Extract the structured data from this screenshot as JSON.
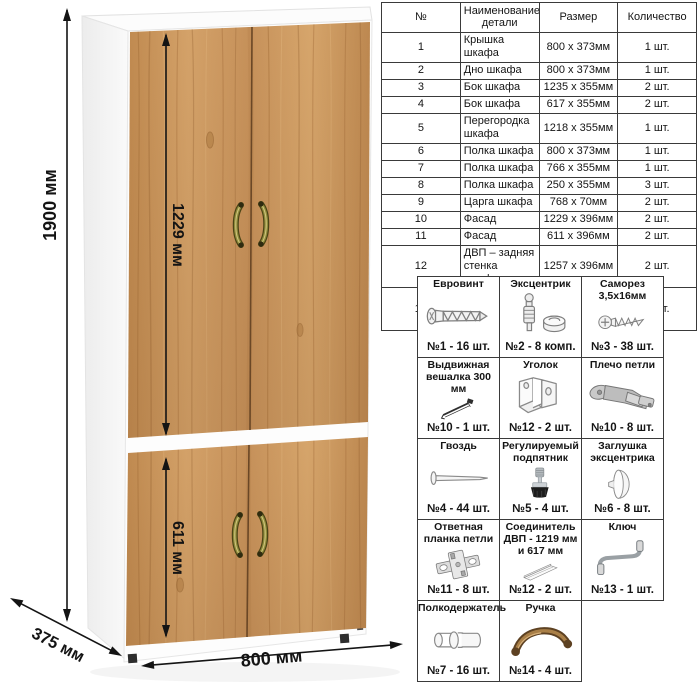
{
  "dimensions": {
    "height": "1900 мм",
    "upper_door_height": "1229 мм",
    "lower_door_height": "611 мм",
    "width": "800 мм",
    "depth": "375 мм"
  },
  "parts_table": {
    "headers": [
      "№",
      "Наименование детали",
      "Размер",
      "Количество"
    ],
    "rows": [
      [
        "1",
        "Крышка шкафа",
        "800 x 373мм",
        "1 шт."
      ],
      [
        "2",
        "Дно шкафа",
        "800 x 373мм",
        "1 шт."
      ],
      [
        "3",
        "Бок шкафа",
        "1235 x 355мм",
        "2 шт."
      ],
      [
        "4",
        "Бок шкафа",
        "617 x 355мм",
        "2 шт."
      ],
      [
        "5",
        "Перегородка шкафа",
        "1218 x 355мм",
        "1 шт."
      ],
      [
        "6",
        "Полка шкафа",
        "800 x 373мм",
        "1 шт."
      ],
      [
        "7",
        "Полка шкафа",
        "766 x 355мм",
        "1 шт."
      ],
      [
        "8",
        "Полка шкафа",
        "250 x 355мм",
        "3 шт."
      ],
      [
        "9",
        "Царга шкафа",
        "768 x 70мм",
        "2 шт."
      ],
      [
        "10",
        "Фасад",
        "1229 x 396мм",
        "2 шт."
      ],
      [
        "11",
        "Фасад",
        "611 x 396мм",
        "2 шт."
      ],
      [
        "12",
        "ДВП – задняя стенка шкафа",
        "1257 x 396мм",
        "2 шт."
      ],
      [
        "13",
        "ДВП – задняя стенка шкафа",
        "639 x 396мм",
        "2 шт."
      ]
    ]
  },
  "hardware": {
    "items": [
      {
        "title": "Евровинт",
        "qty": "№1 - 16 шт.",
        "icon": "euro-screw-icon"
      },
      {
        "title": "Эксцентрик",
        "qty": "№2 - 8 комп.",
        "icon": "cam-lock-icon"
      },
      {
        "title": "Саморез 3,5х16мм",
        "qty": "№3 - 38 шт.",
        "icon": "self-tapping-screw-icon"
      },
      {
        "title": "Выдвижная вешалка 300 мм",
        "qty": "№10 - 1 шт.",
        "icon": "pull-out-hanger-icon"
      },
      {
        "title": "Уголок",
        "qty": "№12 - 2 шт.",
        "icon": "corner-bracket-icon"
      },
      {
        "title": "Плечо петли",
        "qty": "№10 - 8 шт.",
        "icon": "hinge-arm-icon"
      },
      {
        "title": "Гвоздь",
        "qty": "№4 - 44 шт.",
        "icon": "nail-icon"
      },
      {
        "title": "Регулируемый подпятник",
        "qty": "№5 - 4 шт.",
        "icon": "adjustable-foot-icon"
      },
      {
        "title": "Заглушка эксцентрика",
        "qty": "№6 - 8 шт.",
        "icon": "cam-cover-icon"
      },
      {
        "title": "Ответная планка петли",
        "qty": "№11 - 8 шт.",
        "icon": "hinge-plate-icon"
      },
      {
        "title": "Соединитель ДВП - 1219 мм и 617 мм",
        "qty": "№12 - 2 шт.",
        "icon": "hdf-connector-icon"
      },
      {
        "title": "Ключ",
        "qty": "№13 - 1 шт.",
        "icon": "hex-key-icon"
      },
      {
        "title": "Полкодержатель",
        "qty": "№7 - 16 шт.",
        "icon": "shelf-pin-icon"
      },
      {
        "title": "Ручка",
        "qty": "№14 - 4 шт.",
        "icon": "handle-icon"
      }
    ]
  },
  "colors": {
    "wood": "#cc9a60",
    "wood_dark": "#8a5a2c",
    "carcass_white": "#fcfcfc",
    "dimension_line": "#141414",
    "table_border": "#3a3a3a",
    "handle_brass": "#8f8a3a",
    "handle_bronze": "#6e4f2a"
  }
}
